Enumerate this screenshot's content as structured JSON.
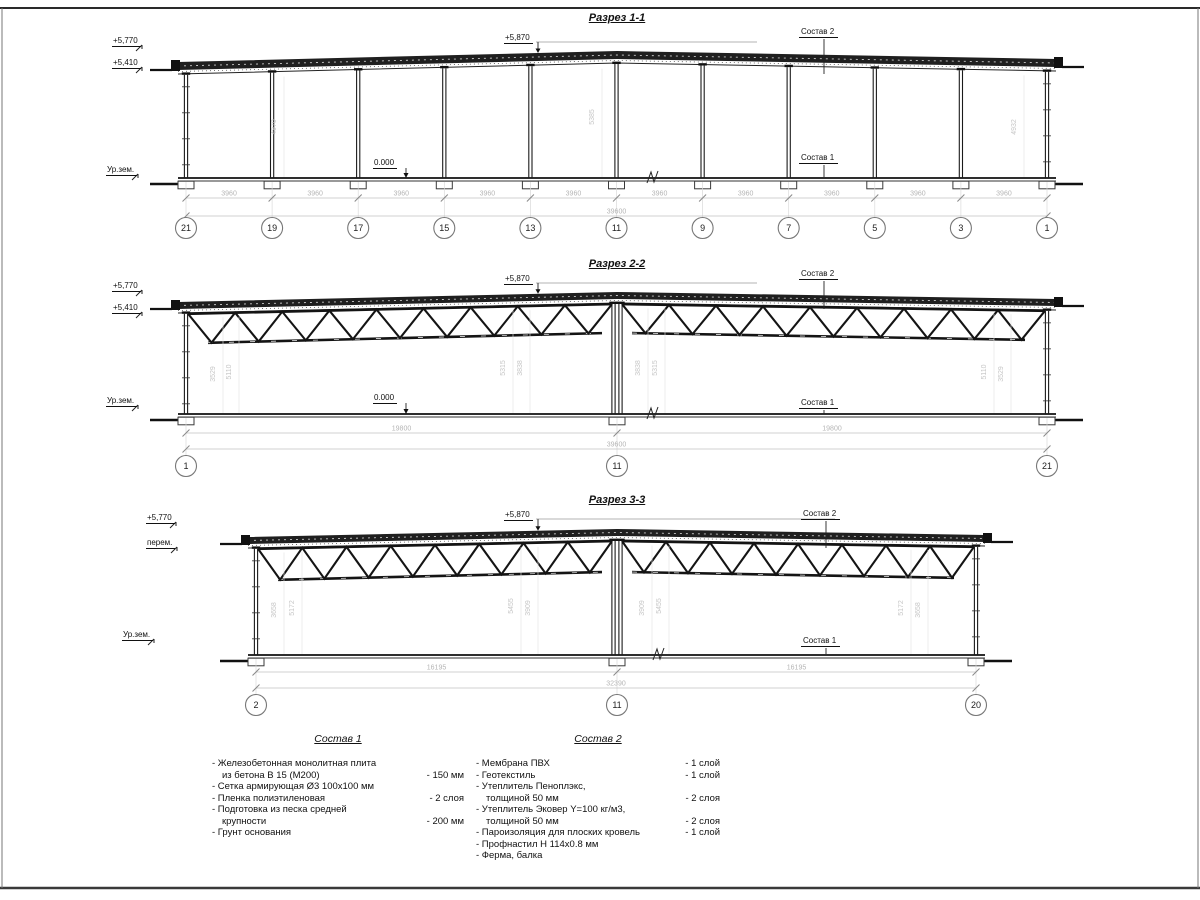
{
  "page": {
    "background": "#ffffff",
    "line_color": "#1c1c1c",
    "dim_color": "#b9b9b9"
  },
  "sections": [
    {
      "title": "Разрез 1-1",
      "elevations": {
        "parapet": "+5,770",
        "roof_bottom": "+5,410",
        "ridge": "+5,870",
        "ground": "Ур.зем.",
        "floor": "0.000"
      },
      "callouts": {
        "roof": "Состав 2",
        "floor": "Состав 1"
      },
      "grid_bubbles": [
        "21",
        "19",
        "17",
        "15",
        "13",
        "11",
        "9",
        "7",
        "5",
        "3",
        "1"
      ],
      "bay_dim": "3960",
      "total_dim": "39600",
      "vertical_dims": [
        "4970",
        "5385",
        "4932"
      ]
    },
    {
      "title": "Разрез 2-2",
      "elevations": {
        "parapet": "+5,770",
        "roof_bottom": "+5,410",
        "ridge": "+5,870",
        "ground": "Ур.зем.",
        "floor": "0.000"
      },
      "callouts": {
        "roof": "Состав 2",
        "floor": "Состав 1"
      },
      "grid_bubbles": [
        "1",
        "11",
        "21"
      ],
      "span_dims": [
        "19800",
        "19800"
      ],
      "total_dim": "39600",
      "vertical_dims": [
        "3529",
        "5110",
        "5315",
        "3838",
        "3838",
        "5315",
        "5110",
        "3529"
      ]
    },
    {
      "title": "Разрез 3-3",
      "elevations": {
        "parapet": "+5,770",
        "roof_bottom": "перем.",
        "ridge": "+5,870",
        "ground": "Ур.зем."
      },
      "callouts": {
        "roof": "Состав 2",
        "floor": "Состав 1"
      },
      "grid_bubbles": [
        "2",
        "11",
        "20"
      ],
      "span_dims": [
        "16195",
        "16195"
      ],
      "total_dim": "32390",
      "vertical_dims": [
        "3658",
        "5172",
        "5455",
        "3909",
        "3909",
        "5455",
        "5172",
        "3658"
      ]
    }
  ],
  "legend": {
    "sostav1": {
      "title": "Состав 1",
      "items": [
        {
          "lines": [
            "- Железобетонная  монолитная плита",
            "из бетона В 15 (М200)"
          ],
          "value": "- 150 мм"
        },
        {
          "lines": [
            "- Сетка армирующая Ø3 100x100 мм"
          ],
          "value": ""
        },
        {
          "lines": [
            "- Пленка полиэтиленовая"
          ],
          "value": "-  2 слоя"
        },
        {
          "lines": [
            "- Подготовка из песка средней",
            "крупности"
          ],
          "value": "- 200 мм"
        },
        {
          "lines": [
            "- Грунт основания"
          ],
          "value": ""
        }
      ]
    },
    "sostav2": {
      "title": "Состав 2",
      "items": [
        {
          "lines": [
            "- Мембрана ПВХ"
          ],
          "value": "- 1 слой"
        },
        {
          "lines": [
            "- Геотекстиль"
          ],
          "value": "- 1 слой"
        },
        {
          "lines": [
            "- Утеплитель Пеноплэкс,",
            "толщиной 50 мм"
          ],
          "value": "- 2 слоя"
        },
        {
          "lines": [
            "- Утеплитель Эковер Y=100 кг/м3,",
            "толщиной 50 мм"
          ],
          "value": "- 2 слоя"
        },
        {
          "lines": [
            "- Пароизоляция для плоских кровель"
          ],
          "value": "- 1 слой"
        },
        {
          "lines": [
            "- Профнастил Н 114х0.8 мм"
          ],
          "value": ""
        },
        {
          "lines": [
            "- Ферма, балка"
          ],
          "value": ""
        }
      ]
    }
  }
}
